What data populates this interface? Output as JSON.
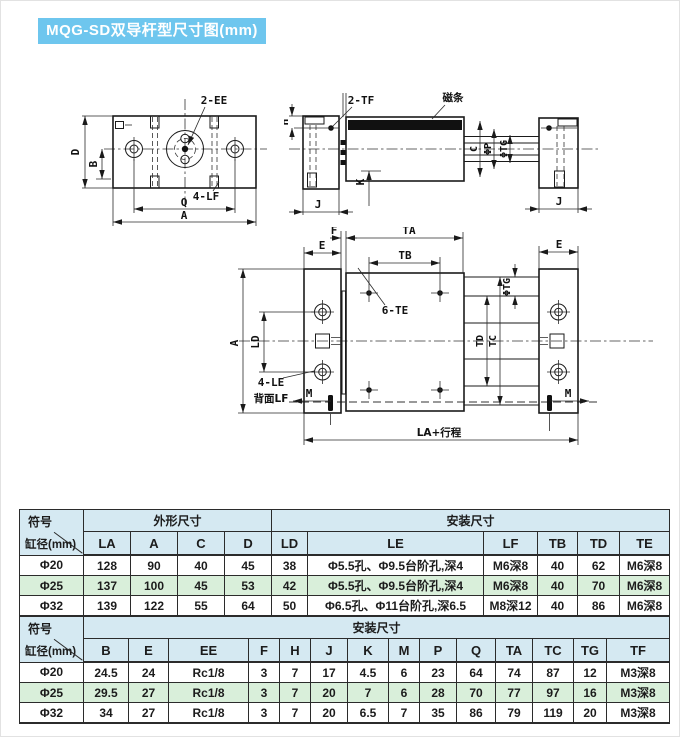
{
  "title": "MQG-SD双导杆型尺寸图(mm)",
  "colors": {
    "title_bg": "#6ec6ee",
    "header_bg": "#d5e9f2",
    "alt_row_bg": "#d9efda",
    "line": "#1a1a1a"
  },
  "drawing": {
    "front": {
      "ee": "2-EE",
      "lf": "4-LF",
      "d": "D",
      "b": "B",
      "q": "Q",
      "a": "A"
    },
    "side": {
      "tf": "2-TF",
      "magnet": "磁条",
      "h": "H",
      "j_left": "J",
      "j_right": "J",
      "k": "K",
      "c": "C",
      "p": "ΦP",
      "tg": "ΦTG"
    },
    "plan": {
      "f": "F",
      "ta": "TA",
      "tb": "TB",
      "e_left": "E",
      "e_right": "E",
      "tg": "ΦTG",
      "td": "TD",
      "tc": "TC",
      "a": "A",
      "ld": "LD",
      "te": "6-TE",
      "le": "4-LE",
      "lf_back": "背面LF",
      "m_left": "M",
      "m_right": "M",
      "la_stroke": "LA+行程"
    }
  },
  "table1": {
    "corner_top": "符号",
    "corner_bottom": "缸径(mm)",
    "group_outline": "外形尺寸",
    "group_mount": "安装尺寸",
    "columns": [
      "LA",
      "A",
      "C",
      "D",
      "LD",
      "LE",
      "LF",
      "TB",
      "TD",
      "TE"
    ],
    "rows": [
      {
        "bore": "Φ20",
        "values": [
          "128",
          "90",
          "40",
          "45",
          "38",
          "Φ5.5孔、Φ9.5台阶孔,深4",
          "M6深8",
          "40",
          "62",
          "M6深8"
        ]
      },
      {
        "bore": "Φ25",
        "values": [
          "137",
          "100",
          "45",
          "53",
          "42",
          "Φ5.5孔、Φ9.5台阶孔,深4",
          "M6深8",
          "40",
          "70",
          "M6深8"
        ]
      },
      {
        "bore": "Φ32",
        "values": [
          "139",
          "122",
          "55",
          "64",
          "50",
          "Φ6.5孔、Φ11台阶孔,深6.5",
          "M8深12",
          "40",
          "86",
          "M6深8"
        ]
      }
    ]
  },
  "table2": {
    "corner_top": "符号",
    "corner_bottom": "缸径(mm)",
    "group_mount": "安装尺寸",
    "columns": [
      "B",
      "E",
      "EE",
      "F",
      "H",
      "J",
      "K",
      "M",
      "P",
      "Q",
      "TA",
      "TC",
      "TG",
      "TF"
    ],
    "rows": [
      {
        "bore": "Φ20",
        "values": [
          "24.5",
          "24",
          "Rc1/8",
          "3",
          "7",
          "17",
          "4.5",
          "6",
          "23",
          "64",
          "74",
          "87",
          "12",
          "M3深8"
        ]
      },
      {
        "bore": "Φ25",
        "values": [
          "29.5",
          "27",
          "Rc1/8",
          "3",
          "7",
          "20",
          "7",
          "6",
          "28",
          "70",
          "77",
          "97",
          "16",
          "M3深8"
        ]
      },
      {
        "bore": "Φ32",
        "values": [
          "34",
          "27",
          "Rc1/8",
          "3",
          "7",
          "20",
          "6.5",
          "7",
          "35",
          "86",
          "79",
          "119",
          "20",
          "M3深8"
        ]
      }
    ]
  }
}
